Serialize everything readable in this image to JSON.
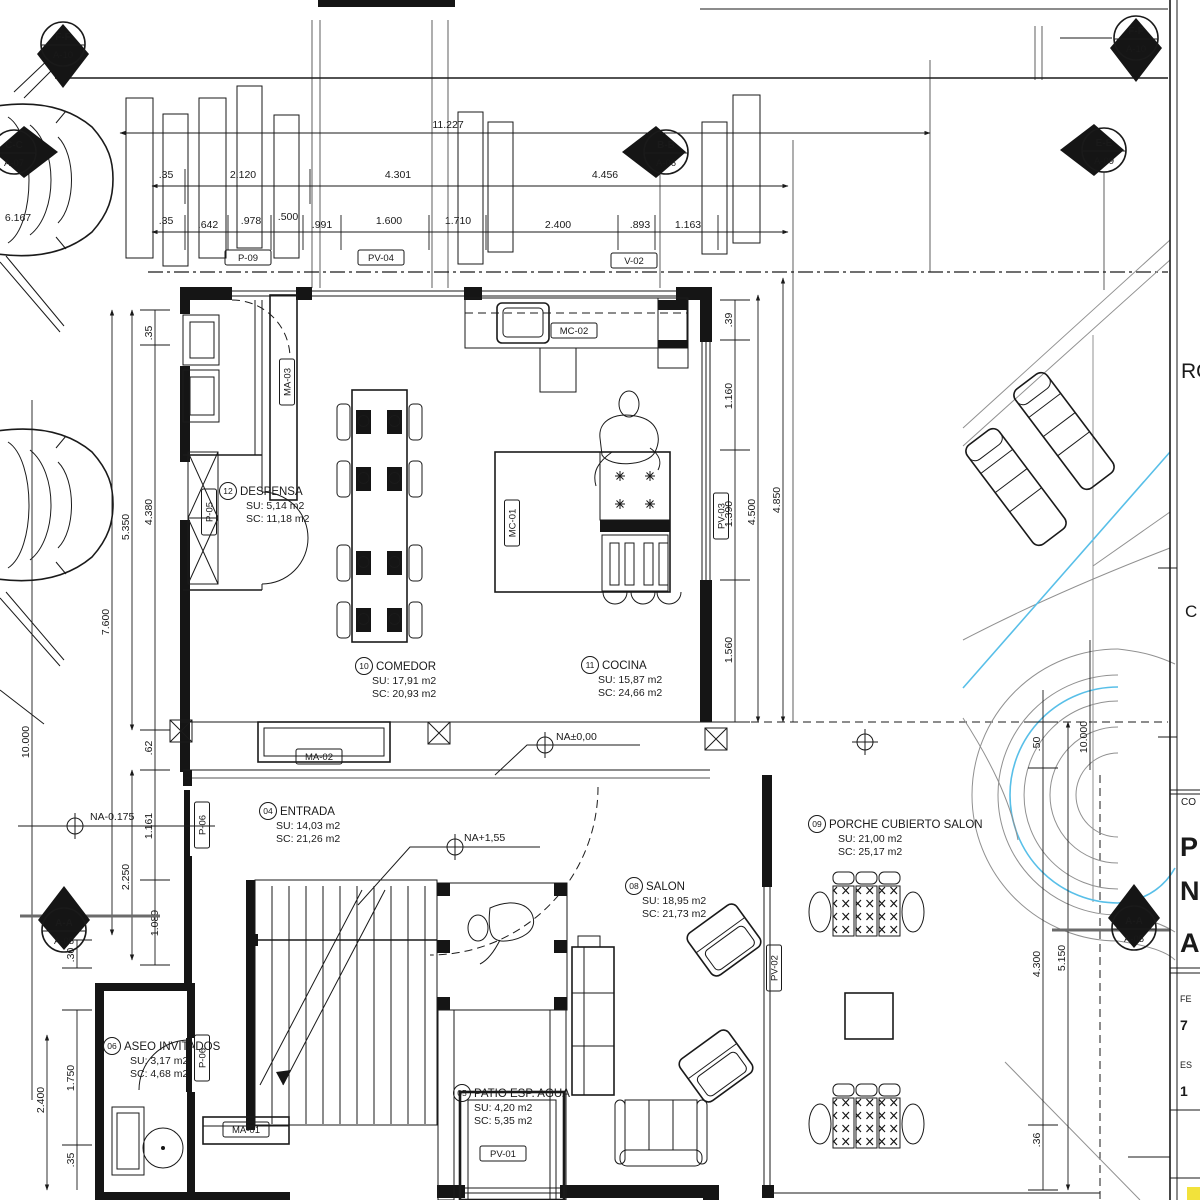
{
  "drawing": {
    "type": "architectural floor plan",
    "colors": {
      "line": "#1a1a1a",
      "construction_gray": "#909090",
      "section_line_gray": "#6b6b6b",
      "pool_blue": "#58bfe8",
      "highlight_yellow": "#f2e23b"
    }
  },
  "section_markers": {
    "ff_left": {
      "name": "F-F",
      "sheet": "A-10"
    },
    "cc": {
      "name": "C-C",
      "sheet": "A-07"
    },
    "bb": {
      "name": "B-B",
      "sheet": "A-06"
    },
    "ee": {
      "name": "E-E",
      "sheet": "A-09"
    },
    "ff_right": {
      "name": "F-F",
      "sheet": "A-10"
    },
    "aa_left": {
      "name": "A-A",
      "sheet": "A-05"
    },
    "aa_right": {
      "name": "A-A",
      "sheet": "A-05"
    }
  },
  "rooms": {
    "despensa": {
      "number": "12",
      "name": "DESPENSA",
      "su": "SU: 5,14 m2",
      "sc": "SC: 11,18 m2"
    },
    "comedor": {
      "number": "10",
      "name": "COMEDOR",
      "su": "SU: 17,91 m2",
      "sc": "SC: 20,93 m2"
    },
    "cocina": {
      "number": "11",
      "name": "COCINA",
      "su": "SU: 15,87 m2",
      "sc": "SC: 24,66 m2"
    },
    "entrada": {
      "number": "04",
      "name": "ENTRADA",
      "su": "SU: 14,03 m2",
      "sc": "SC: 21,26 m2"
    },
    "salon": {
      "number": "08",
      "name": "SALON",
      "su": "SU: 18,95 m2",
      "sc": "SC: 21,73 m2"
    },
    "porche": {
      "number": "09",
      "name": "PORCHE CUBIERTO SALON",
      "su": "SU: 21,00 m2",
      "sc": "SC: 25,17 m2"
    },
    "aseo": {
      "number": "06",
      "name": "ASEO INVITADOS",
      "su": "SU: 3,17 m2",
      "sc": "SC: 4,68 m2"
    },
    "patio": {
      "number": "05",
      "name": "PATIO ESP. AGUA",
      "su": "SU: 4,20 m2",
      "sc": "SC: 5,35 m2"
    }
  },
  "levels": {
    "exterior": "NA-0.175",
    "ground": "NA±0,00",
    "upper": "NA+1,55"
  },
  "tags": {
    "p09": "P-09",
    "pv04": "PV-04",
    "v02": "V-02",
    "mc02": "MC-02",
    "mc01": "MC-01",
    "ma03": "MA-03",
    "pv03": "PV-03",
    "ma02": "MA-02",
    "ma01": "MA-01",
    "pv01": "PV-01",
    "pv02": "PV-02",
    "p06_entrada": "P-06",
    "p06_aseo": "P-06",
    "p05": "P-05"
  },
  "dimensions": {
    "total_width": "11.227",
    "left_edge": "6.167",
    "top_row": [
      ".35",
      "2.120",
      "4.301",
      "4.456"
    ],
    "detail_row": [
      ".35",
      ".642",
      ".978",
      ".500",
      ".991",
      "1.600",
      "1.710",
      "2.400",
      ".893",
      "1.163"
    ],
    "left_col": [
      "10.000",
      "7.600",
      "5.350",
      "4.380",
      ".35",
      ".62",
      "1.161",
      "2.250",
      "1.089",
      ".30",
      "2.400",
      "1.750",
      ".35"
    ],
    "right_col": [
      ".39",
      "1.160",
      "1.390",
      "1.560",
      "4.500",
      "4.850"
    ],
    "far_right_col": [
      ".50",
      "10.000",
      "4.300",
      "5.150",
      ".36"
    ]
  },
  "title_block": {
    "fragments": [
      "RO",
      "C",
      "CO",
      "P",
      "N",
      "A",
      "FE",
      "7",
      "ES",
      "1"
    ]
  }
}
